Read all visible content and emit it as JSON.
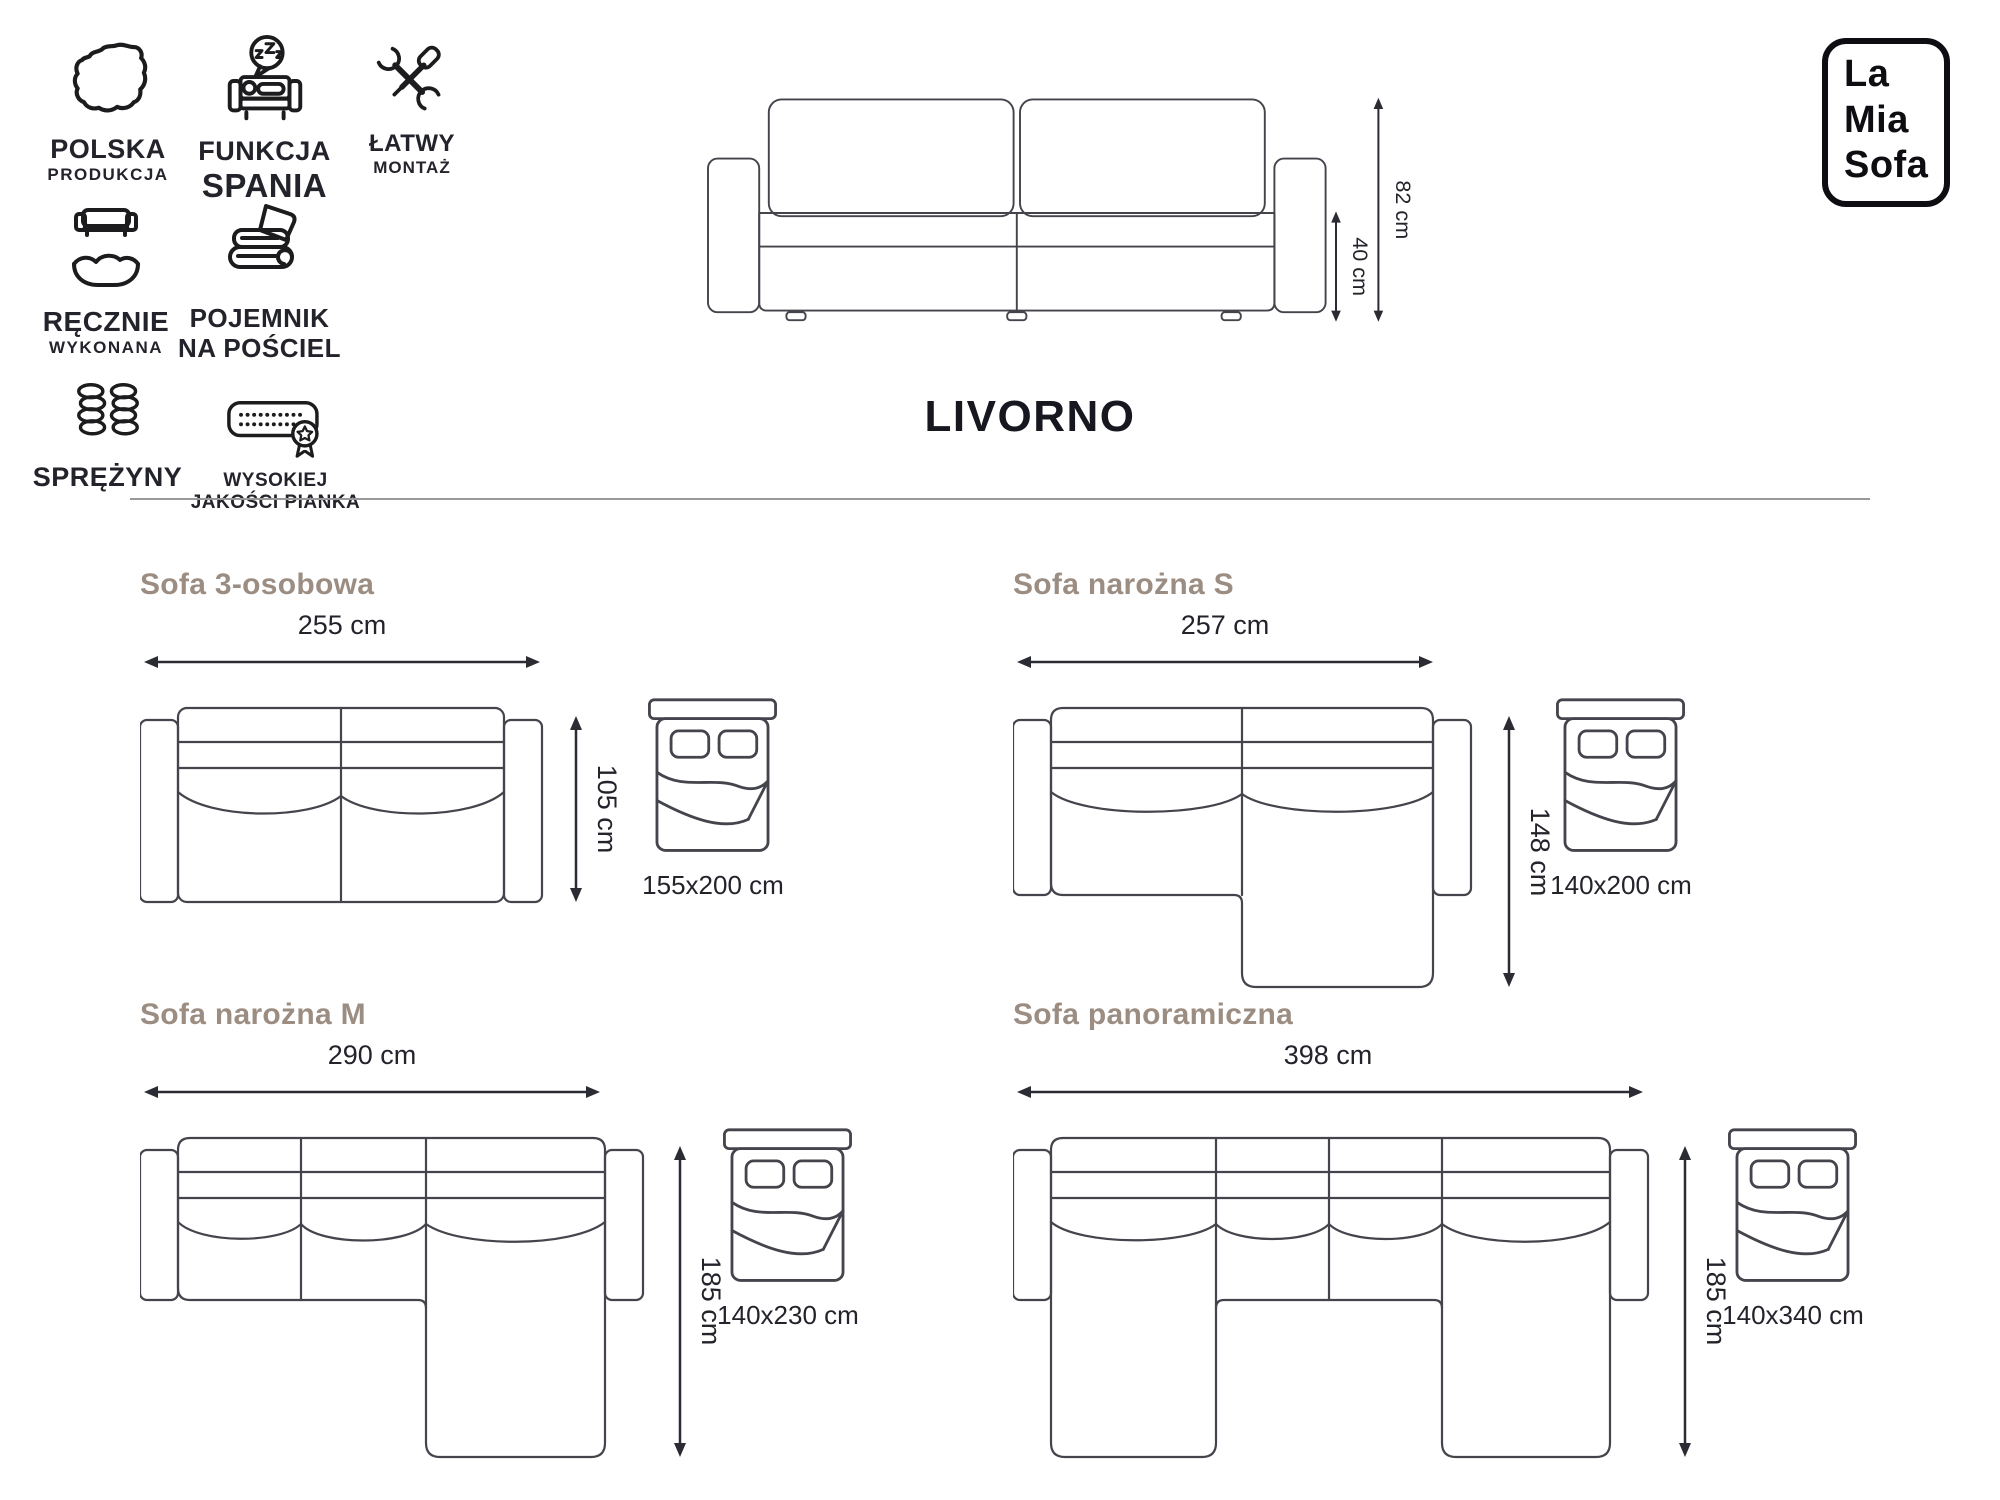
{
  "brand": {
    "logo_lines": [
      "La",
      "Mia",
      "Sofa"
    ]
  },
  "product": {
    "title": "LIVORNO"
  },
  "hero": {
    "total_height": "82 cm",
    "seat_height": "40 cm"
  },
  "features": [
    {
      "icon": "poland-map-icon",
      "line1": "POLSKA",
      "line2": "PRODUKCJA"
    },
    {
      "icon": "sleep-function-icon",
      "line1": "FUNKCJA",
      "line2": "SPANIA"
    },
    {
      "icon": "easy-assembly-icon",
      "line1": "ŁATWY",
      "line2": "MONTAŻ"
    },
    {
      "icon": "handmade-icon",
      "line1": "RĘCZNIE",
      "line2": "WYKONANA"
    },
    {
      "icon": "bedding-storage-icon",
      "line1": "POJEMNIK",
      "line2": "NA POŚCIEL"
    },
    {
      "icon": "springs-icon",
      "line1": "SPRĘŻYNY",
      "line2": ""
    },
    {
      "icon": "foam-quality-icon",
      "line1": "WYSOKIEJ",
      "line2": "JAKOŚCI PIANKA"
    }
  ],
  "variants": [
    {
      "title": "Sofa 3-osobowa",
      "width": "255 cm",
      "depth": "105 cm",
      "bed": "155x200 cm"
    },
    {
      "title": "Sofa narożna S",
      "width": "257 cm",
      "depth": "148 cm",
      "bed": "140x200 cm"
    },
    {
      "title": "Sofa narożna M",
      "width": "290 cm",
      "depth": "185 cm",
      "bed": "140x230 cm"
    },
    {
      "title": "Sofa panoramiczna",
      "width": "398 cm",
      "depth": "185 cm",
      "bed": "140x340 cm"
    }
  ],
  "colors": {
    "heading": "#9c8d82",
    "line_art": "#44444c",
    "dimension": "#2b2b33",
    "divider": "#999999",
    "logo": "#0d0d12"
  }
}
